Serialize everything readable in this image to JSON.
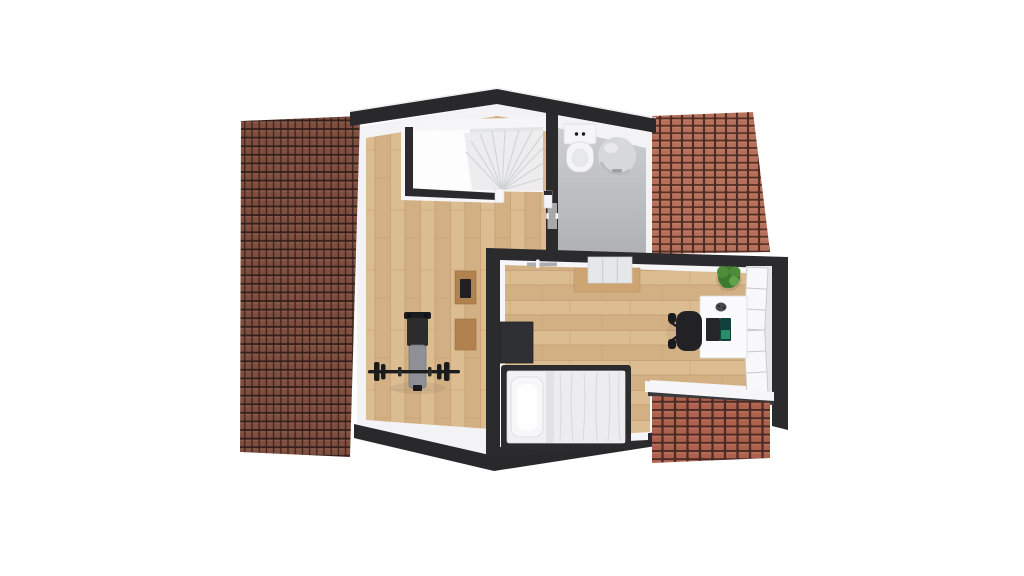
{
  "scene": {
    "type": "3d-floor-plan-top-view",
    "floor": "attic-storey",
    "rooms": [
      {
        "name": "landing",
        "objects": [
          "staircase",
          "wall-cabinet-upper",
          "wall-cabinet-lower",
          "weight-bench",
          "barbell"
        ]
      },
      {
        "name": "bathroom",
        "objects": [
          "toilet",
          "water-heater",
          "bathroom-door"
        ]
      },
      {
        "name": "bedroom",
        "objects": [
          "single-bed",
          "pillow",
          "duvet",
          "nightstand",
          "dresser",
          "plant",
          "desk",
          "laptop",
          "office-chair",
          "open-window",
          "window-ledge",
          "dormer-roof"
        ]
      }
    ]
  },
  "palette": {
    "pageBg": "#ffffff",
    "footprintWhite": "#f3f3f5",
    "wallDark": "#2b2b2e",
    "ridgeDark": "#29292c",
    "wallWhite": "#f6f6f8",
    "trimShadow": "#dcdcdf",
    "shelfGray": "#e3e4e6",
    "woodPlankA": "#dcbd92",
    "woodPlankB": "#d3b084",
    "woodSeam": "#c09a6c",
    "bathTop": "#cdced1",
    "bathBottom": "#b0b1b4",
    "tileLeftGap": "#34211b",
    "tileLeft": "#7f4e3f",
    "tileLeftHi": "#94604e",
    "tileRightGap": "#502d24",
    "tileRight": "#b4705a",
    "tileRightHi": "#c68068",
    "tileDormerGap": "#4e2c25",
    "tileDormer": "#ad614d",
    "tileDormerHi": "#bd7460",
    "stairField": "#ededef",
    "stairLine": "#d2d3d6",
    "fixtureWhite": "#f5f5f7",
    "boilerGray": "#d7d8da",
    "doorGray": "#a7a8ab",
    "bedFrame": "#2c2c2f",
    "mattressWhite": "#f1f1f3",
    "pillowWhite": "#f7f7f9",
    "duvetFold": "#d8d9dc",
    "nightstandDark": "#2f3033",
    "dresserWood": "#cda573",
    "drawerWhite": "#e6e7e9",
    "plantDark": "#3c7a30",
    "plantMid": "#4e8c39",
    "plantLight": "#61a34a",
    "deskWhite": "#fbfbfd",
    "chairBlack": "#222226",
    "laptopBody": "#24262a",
    "laptopScreen": "#10403b",
    "laptopGlow": "#2e9c6e",
    "cabinetWood": "#b1824f",
    "cabinetItem": "#202024",
    "benchPad": "#8f9095",
    "gymBlack": "#1a1b1d",
    "ledgeWhite": "#f6f6f8",
    "ledgeEdge": "#3a3a3d",
    "windowWhite": "#f8f8fa",
    "windowLine": "#c7c8cb",
    "jambReveal": "#e7e7e9"
  }
}
